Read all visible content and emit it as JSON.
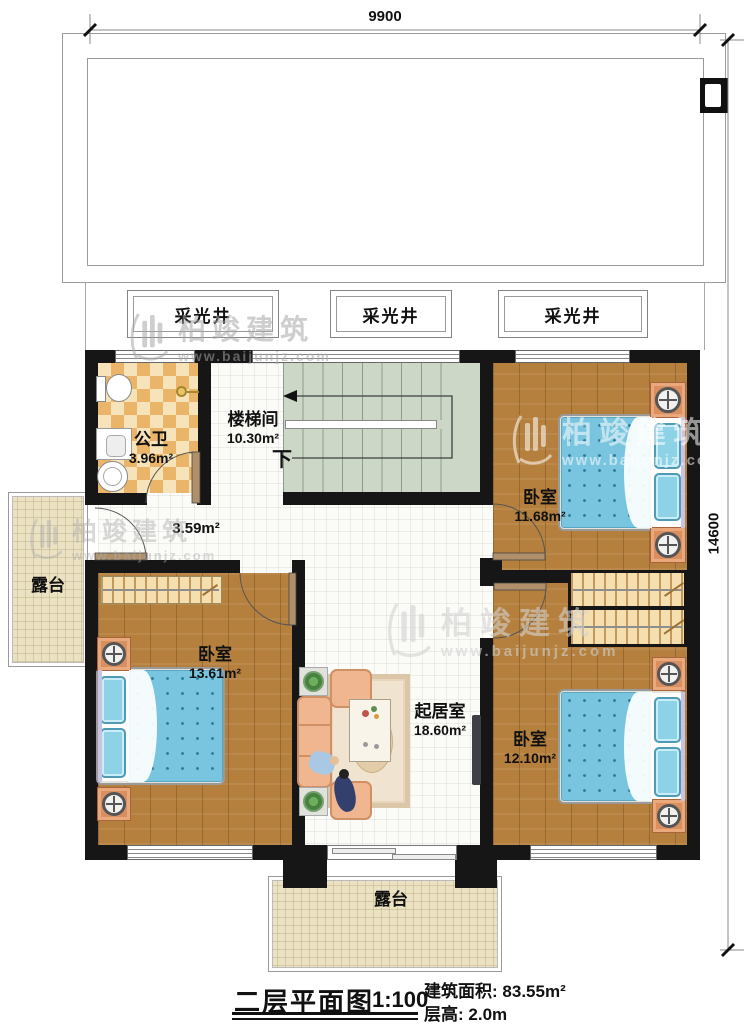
{
  "plan": {
    "dim_width": "9900",
    "dim_height": "14600",
    "skylights": [
      "采光井",
      "采光井",
      "采光井"
    ],
    "bathroom": {
      "room": "公卫",
      "area": "3.96m²"
    },
    "stairwell": {
      "room": "楼梯间",
      "area": "10.30m²",
      "down": "下"
    },
    "hallway": {
      "area": "3.59m²"
    },
    "bedroom_top_right": {
      "room": "卧室",
      "area": "11.68m²"
    },
    "bedroom_left": {
      "room": "卧室",
      "area": "13.61m²"
    },
    "bedroom_bottom_right": {
      "room": "卧室",
      "area": "12.10m²"
    },
    "living_room": {
      "room": "起居室",
      "area": "18.60m²"
    },
    "terrace_left": {
      "room": "露台"
    },
    "terrace_bottom": {
      "room": "露台"
    }
  },
  "title_block": {
    "title": "二层平面图",
    "scale": "1:100",
    "area_label": "建筑面积:",
    "area_value": "83.55m²",
    "height_label": "层高:",
    "height_value": "2.0m"
  },
  "watermark": {
    "name": "柏竣建筑",
    "url": "www.baijunjz.com"
  },
  "colors": {
    "wall": "#161616",
    "wood": "#b5803d",
    "stairs": "#cdd7c7",
    "tile_a": "#eab569",
    "tile_b": "#f7e3ba",
    "terrace": "#ebe2c4",
    "bed": "#79c4de",
    "sofa": "#efb690"
  }
}
